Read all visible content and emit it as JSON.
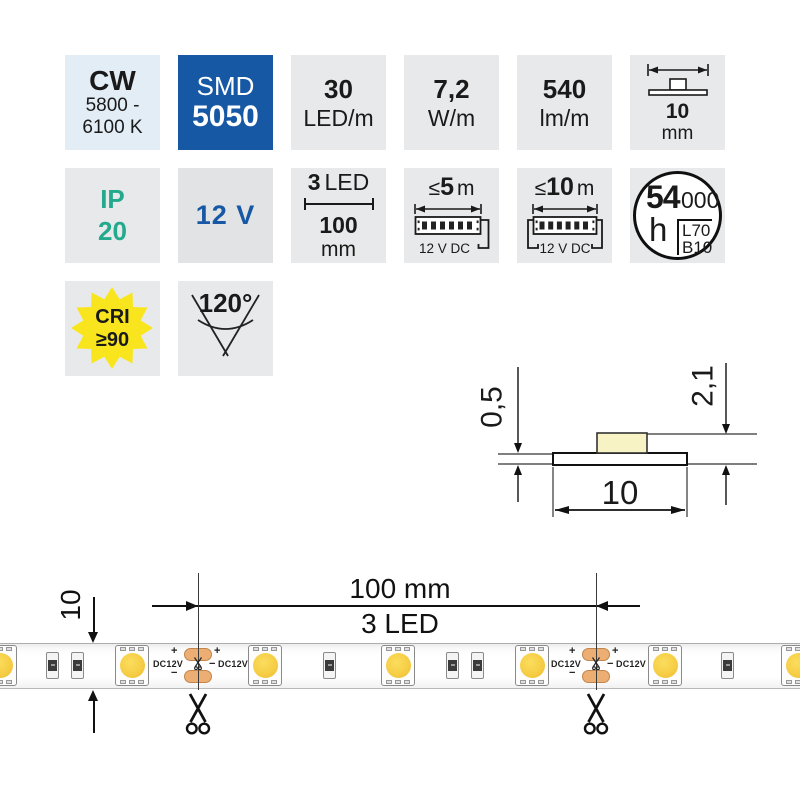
{
  "badges": {
    "color_temp": {
      "title": "CW",
      "range1": "5800 -",
      "range2": "6100 K"
    },
    "chip": {
      "type": "SMD",
      "size": "5050"
    },
    "density": {
      "value": "30",
      "unit": "LED/m"
    },
    "power": {
      "value": "7,2",
      "unit": "W/m"
    },
    "flux": {
      "value": "540",
      "unit": "lm/m"
    },
    "width": {
      "value": "10",
      "unit": "mm"
    },
    "protection": {
      "line1": "IP",
      "line2": "20"
    },
    "voltage": {
      "value": "12 V"
    },
    "cut": {
      "count": "3",
      "count_unit": "LED",
      "length": "100",
      "length_unit": "mm"
    },
    "max_run_single": {
      "prefix": "≤",
      "value": "5",
      "unit": "m",
      "supply": "12 V DC"
    },
    "max_run_dual": {
      "prefix": "≤",
      "value": "10",
      "unit": "m",
      "supply": "12 V DC"
    },
    "lifetime": {
      "value": "54",
      "zeros": "000",
      "unit": "h",
      "l_rating": "L70",
      "b_rating": "B10"
    },
    "cri": {
      "label": "CRI",
      "value": "≥90"
    },
    "beam_angle": {
      "value": "120°"
    }
  },
  "cross_section": {
    "thickness": "0,5",
    "total_height": "2,1",
    "width": "10"
  },
  "strip": {
    "module_length": "100 mm",
    "module_leds": "3 LED",
    "width_label": "10",
    "plus": "+",
    "minus": "−",
    "supply": "DC12V"
  },
  "colors": {
    "accent_blue": "#1658A4",
    "accent_teal": "#23A98C",
    "badge_gray": "#E8E9EA",
    "cw_badge_bg": "#E3EDF6",
    "cri_yellow": "#F9E51D",
    "led_yellow": "#F6CE45",
    "solder_pad_orange": "#ECAE72",
    "chip_pale_yellow": "#F8F3C4"
  }
}
